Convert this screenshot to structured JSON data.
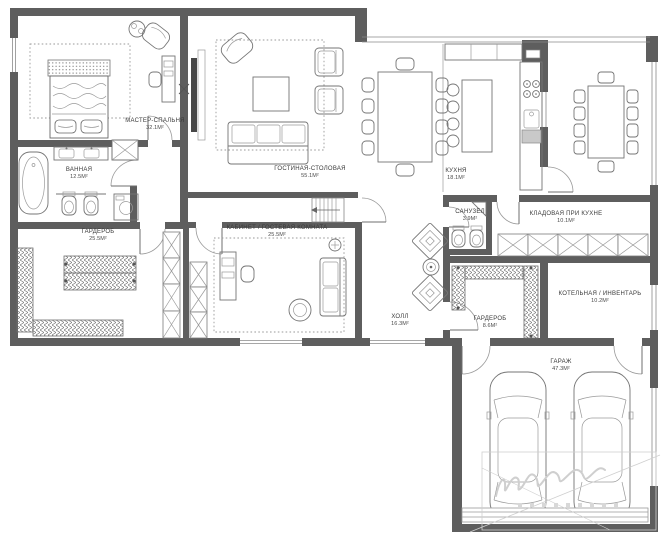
{
  "colors": {
    "wall": "#5e5e5e",
    "line": "#757575",
    "text": "#3a3a3a",
    "watermark": "#cfcfcf",
    "background": "#ffffff"
  },
  "rooms": [
    {
      "id": "master-bedroom",
      "name": "МАСТЕР-СПАЛЬНЯ",
      "area": "32.1м²"
    },
    {
      "id": "bathroom",
      "name": "ВАННАЯ",
      "area": "12.5м²"
    },
    {
      "id": "wardrobe-master",
      "name": "ГАРДЕРОБ",
      "area": "25.5м²"
    },
    {
      "id": "living-dining",
      "name": "ГОСТИНАЯ-СТОЛОВАЯ",
      "area": "55.1м²"
    },
    {
      "id": "kitchen",
      "name": "КУХНЯ",
      "area": "18.1м²"
    },
    {
      "id": "pantry",
      "name": "КЛАДОВАЯ ПРИ КУХНЕ",
      "area": "10.1м²"
    },
    {
      "id": "study-guest",
      "name": "КАБИНЕТ / ГОСТЕВАЯ КОМНАТА",
      "area": "25.5м²"
    },
    {
      "id": "hall",
      "name": "ХОЛЛ",
      "area": "16.3м²"
    },
    {
      "id": "wc",
      "name": "САНУЗЕЛ",
      "area": "3.9м²"
    },
    {
      "id": "wardrobe-hall",
      "name": "ГАРДЕРОБ",
      "area": "8.6м²"
    },
    {
      "id": "boiler",
      "name": "КОТЕЛЬНАЯ / ИНВЕНТАРЬ",
      "area": "10.2м²"
    },
    {
      "id": "garage",
      "name": "ГАРАЖ",
      "area": "47.3м²"
    }
  ]
}
